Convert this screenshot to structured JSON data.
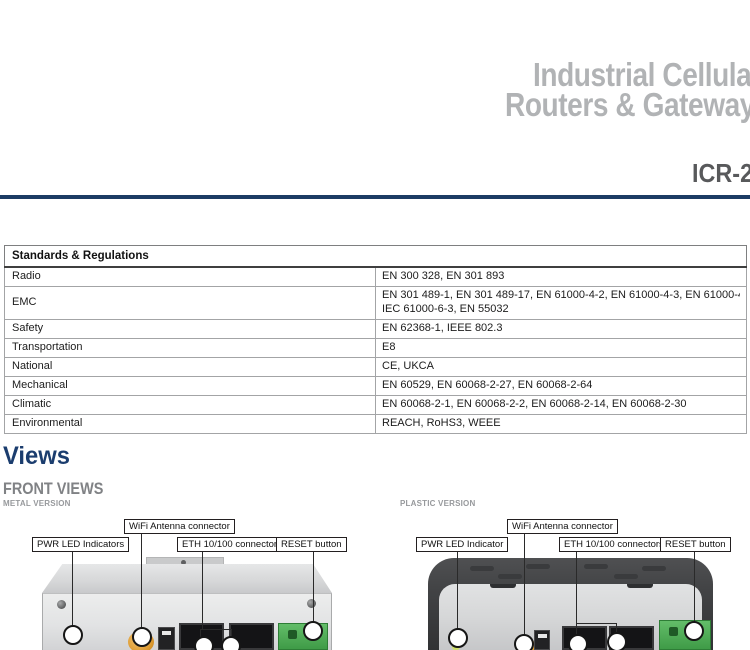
{
  "header": {
    "title_line1": "Industrial Cellular",
    "title_line2": "Routers & Gateways",
    "model": "ICR-27"
  },
  "table": {
    "header": "Standards & Regulations",
    "rows": [
      {
        "label": "Radio",
        "value": "EN 300 328, EN 301 893"
      },
      {
        "label": "EMC",
        "value": "EN 301 489-1, EN 301 489-17, EN 61000-4-2, EN 61000-4-3, EN 61000-4-4, EN 61000-4-5, EN 61000-4-6, EN 61000-4-11, IEC 61000-6-\nIEC 61000-6-3, EN 55032"
      },
      {
        "label": "Safety",
        "value": "EN 62368-1, IEEE 802.3"
      },
      {
        "label": "Transportation",
        "value": "E8"
      },
      {
        "label": "National",
        "value": "CE, UKCA"
      },
      {
        "label": "Mechanical",
        "value": "EN 60529, EN 60068-2-27, EN 60068-2-64"
      },
      {
        "label": "Climatic",
        "value": "EN 60068-2-1, EN 60068-2-2, EN 60068-2-14, EN 60068-2-30"
      },
      {
        "label": "Environmental",
        "value": "REACH, RoHS3, WEEE"
      }
    ]
  },
  "views": {
    "section_title": "Views",
    "subsection_title": "FRONT VIEWS",
    "metal": {
      "version_label": "METAL VERSION",
      "callouts": {
        "pwr": "PWR LED Indicators",
        "wifi": "WiFi Antenna connector",
        "eth": "ETH 10/100 connectors",
        "reset": "RESET button"
      }
    },
    "plastic": {
      "version_label": "PLASTIC VERSION",
      "callouts": {
        "pwr": "PWR LED Indicator",
        "wifi": "WiFi Antenna connector",
        "eth": "ETH 10/100 connectors",
        "reset": "RESET button"
      }
    }
  },
  "colors": {
    "accent_navy": "#1c3c64",
    "heading_blue": "#1b3d6e",
    "title_gray": "#b1b3b5",
    "subtitle_gray": "#808285",
    "version_label_gray": "#97999c",
    "terminal_green": "#3f9b47",
    "antenna_orange": "#dd9a30"
  }
}
